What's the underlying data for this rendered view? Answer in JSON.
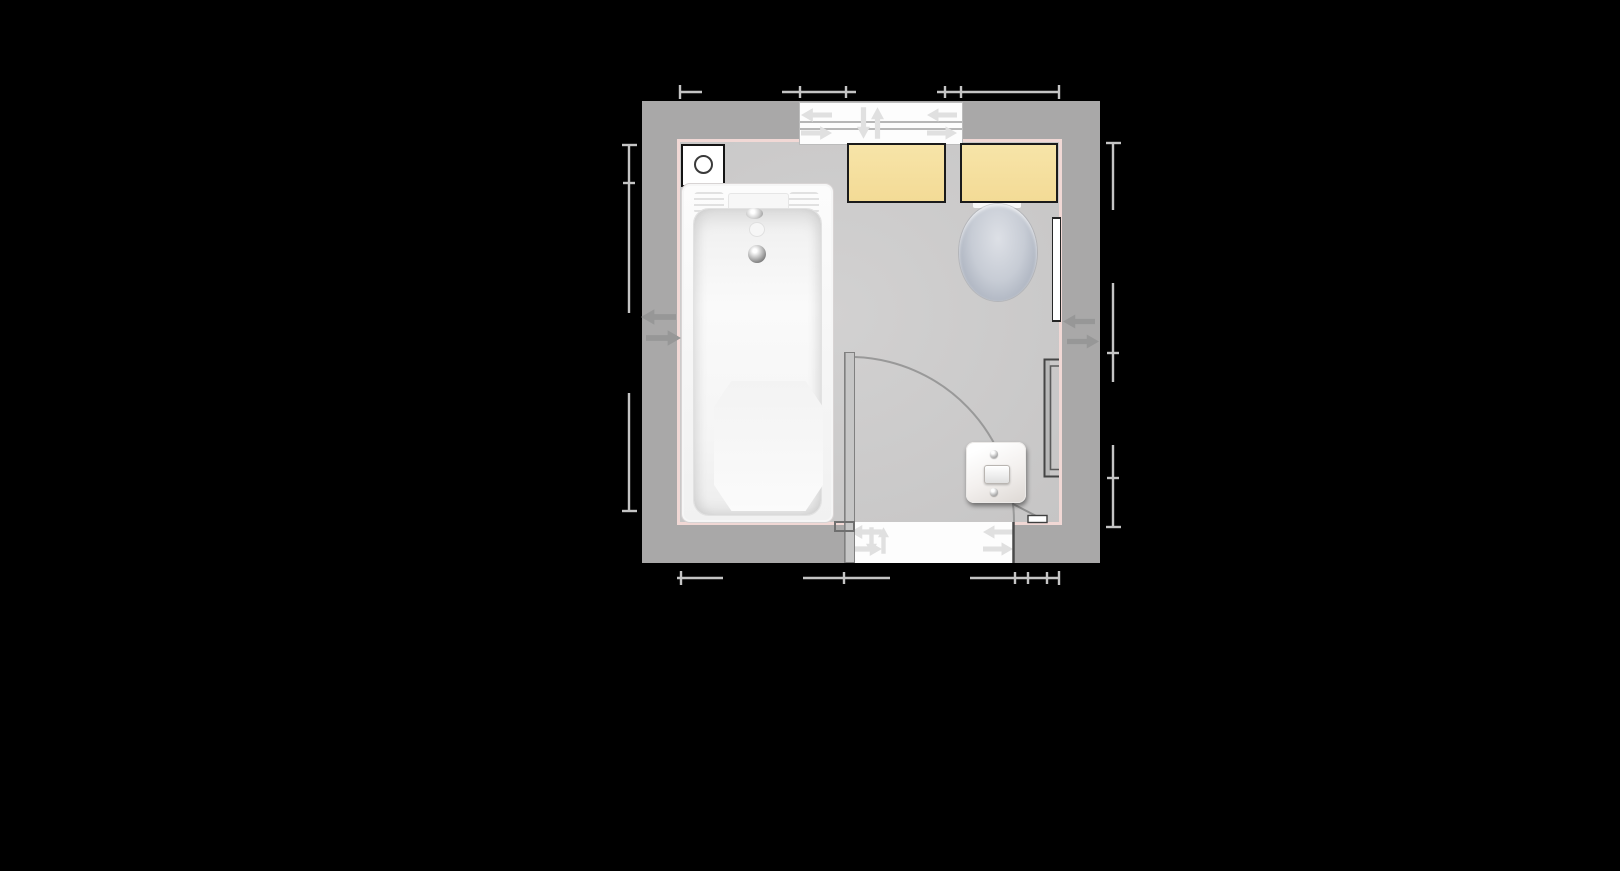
{
  "app": {
    "view": "bathroom-floor-plan",
    "style": "top-down 2d plan on black canvas",
    "visible_text": []
  },
  "colors": {
    "bg": "#000000",
    "wall": "#a9a8a8",
    "floor": "#cbcaca",
    "wallline": "#f1d8d5",
    "dim": "#c4c4c4",
    "arrowlight": "#e0e0e0",
    "arrowwall": "#979797",
    "white": "#fdfdfd",
    "cabinet": "#f5df9f",
    "cabinetborder": "#1b1b1b",
    "tub": "#fafafa",
    "tubline": "#d8d4d4",
    "toilethi": "#dde0e6",
    "toiletlo": "#a9b0bd",
    "darkline": "#4a4a4a",
    "leaf": "#c6c6c6",
    "leafline": "#808080",
    "switchface": "#f3f0ee"
  },
  "room": {
    "shape": "rectangle",
    "walls": "gray with pale pink interior outline",
    "fixtures": [
      {
        "id": "sliding-window",
        "wall": "top",
        "icon_arrows": [
          "left",
          "right",
          "down",
          "up",
          "left",
          "right"
        ]
      },
      {
        "id": "extractor-fan",
        "corner": "top-left"
      },
      {
        "id": "bathtub",
        "wall": "left"
      },
      {
        "id": "cabinet-1",
        "wall": "top",
        "color": "#f5df9f"
      },
      {
        "id": "cabinet-2",
        "wall": "top",
        "color": "#f5df9f"
      },
      {
        "id": "toilet",
        "wall": "top-right"
      },
      {
        "id": "wall-mirror",
        "wall": "right"
      },
      {
        "id": "radiator",
        "wall": "right"
      },
      {
        "id": "door",
        "wall": "bottom",
        "swing": "90-degree arc into room",
        "icon_arrows": [
          "left",
          "right",
          "down",
          "up",
          "left",
          "right"
        ]
      },
      {
        "id": "light-switch",
        "area": "bottom-right"
      },
      {
        "id": "wall-shelf-strip",
        "area": "bottom-right"
      }
    ],
    "wall_flip_handles": [
      {
        "wall": "left",
        "arrows": [
          "left",
          "right"
        ]
      },
      {
        "wall": "right",
        "arrows": [
          "left",
          "right"
        ]
      }
    ],
    "dimension_guides": {
      "top": {
        "tick_count": 6
      },
      "bottom": {
        "tick_count": 7
      },
      "left": {
        "tick_count": 4
      },
      "right": {
        "tick_count": 5
      }
    }
  }
}
